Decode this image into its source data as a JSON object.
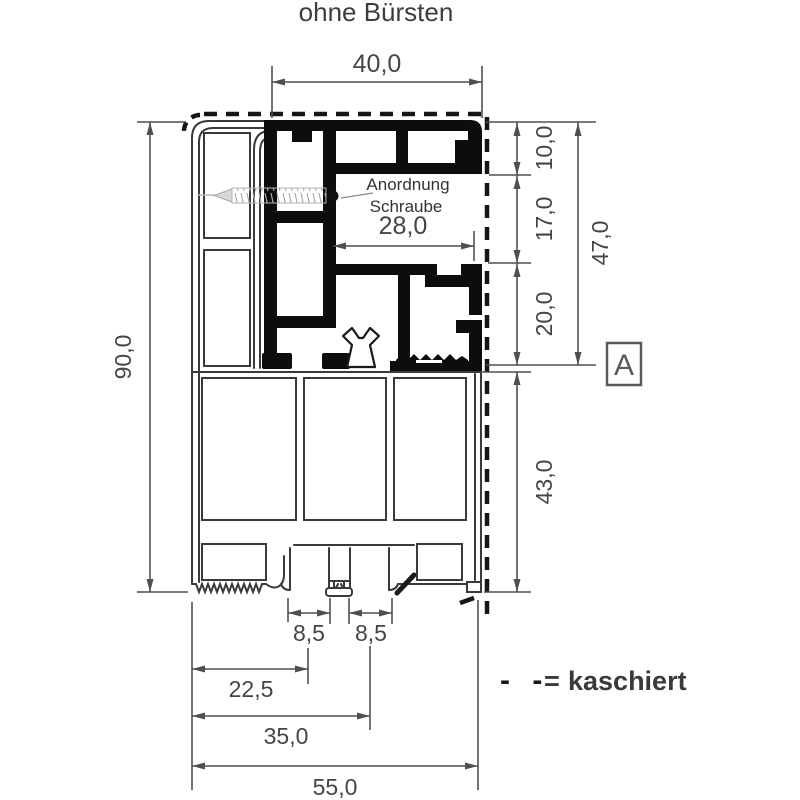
{
  "title": "ohne Bürsten",
  "annotation": {
    "line1": "Anordnung",
    "line2": "Schraube"
  },
  "detail_marker": "A",
  "legend": {
    "dashes": "- -",
    "equals": "=",
    "label": "kaschiert"
  },
  "dims": {
    "top_width": "40,0",
    "screw_width": "28,0",
    "seg_10": "10,0",
    "seg_17": "17,0",
    "seg_20": "20,0",
    "upper_total": "47,0",
    "lower": "43,0",
    "height": "90,0",
    "groove_left": "8,5",
    "groove_right": "8,5",
    "bottom_22": "22,5",
    "bottom_35": "35,0",
    "bottom_total": "55,0"
  },
  "colors": {
    "profile_line": "#3a3a3a",
    "dimension_line": "#4f4f4f",
    "dimension_text": "#454545",
    "black_fill": "#0d0d0d",
    "dashed_kaschiert": "#161616",
    "screw_gray": "#b5b5b5",
    "marker_gray": "#5a5a5a"
  }
}
